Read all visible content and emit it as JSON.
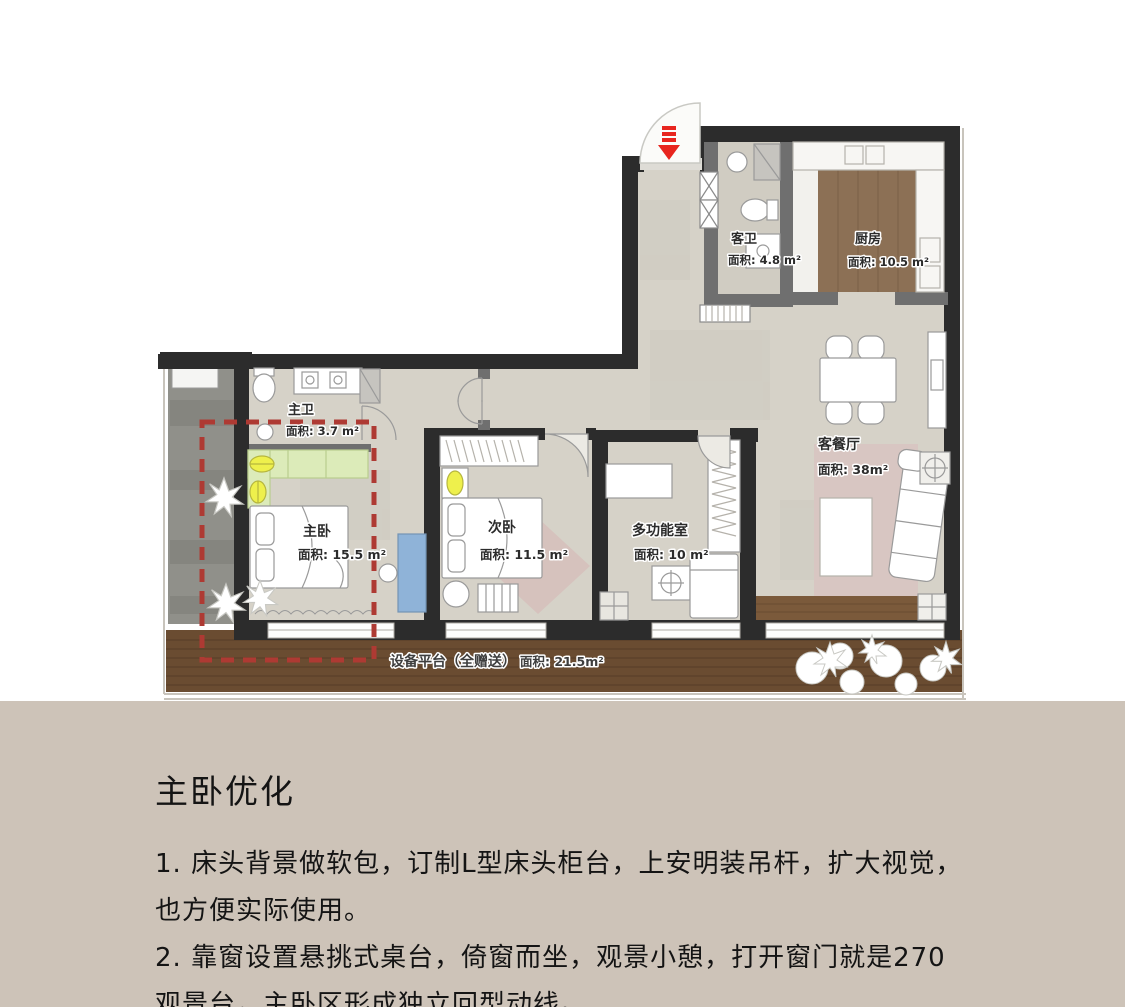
{
  "floor_plan": {
    "rooms": [
      {
        "id": "guest_bath",
        "name": "客卫",
        "area": "面积: 4.8 m²"
      },
      {
        "id": "kitchen",
        "name": "厨房",
        "area": "面积: 10.5 m²"
      },
      {
        "id": "master_bath",
        "name": "主卫",
        "area": "面积: 3.7 m²"
      },
      {
        "id": "master_bedroom",
        "name": "主卧",
        "area": "面积: 15.5 m²"
      },
      {
        "id": "second_bedroom",
        "name": "次卧",
        "area": "面积: 11.5 m²"
      },
      {
        "id": "multi_room",
        "name": "多功能室",
        "area": "面积: 10 m²"
      },
      {
        "id": "living_dining",
        "name": "客餐厅",
        "area": "面积: 38m²"
      },
      {
        "id": "equipment_deck",
        "name": "设备平台（全赠送）",
        "area": "面积: 21.5m²"
      }
    ],
    "colors": {
      "wall": "#2c2c2c",
      "floor": "#d6d2c8",
      "kitchen_wood": "#8c7055",
      "deck_wood": "#6a4c31",
      "terrace_stone": "#90908a",
      "wardrobe_green": "#dcebb9",
      "lamp_yellow": "#eef04c",
      "desk_blue": "#8fb3d8",
      "rug_pink": "#d8c6c2",
      "highlight_dashed_red": "#ae3a33",
      "entry_arrow_red": "#e8251f",
      "panel_background": "#cdc3b8"
    }
  },
  "notes": {
    "title": "主卧优化",
    "lines": [
      "1. 床头背景做软包，订制L型床头柜台，上安明装吊杆，扩大视觉，",
      "也方便实际使用。",
      "2. 靠窗设置悬挑式桌台，倚窗而坐，观景小憩，打开窗门就是270",
      "观景台，主卧区形成独立回型动线。"
    ]
  }
}
